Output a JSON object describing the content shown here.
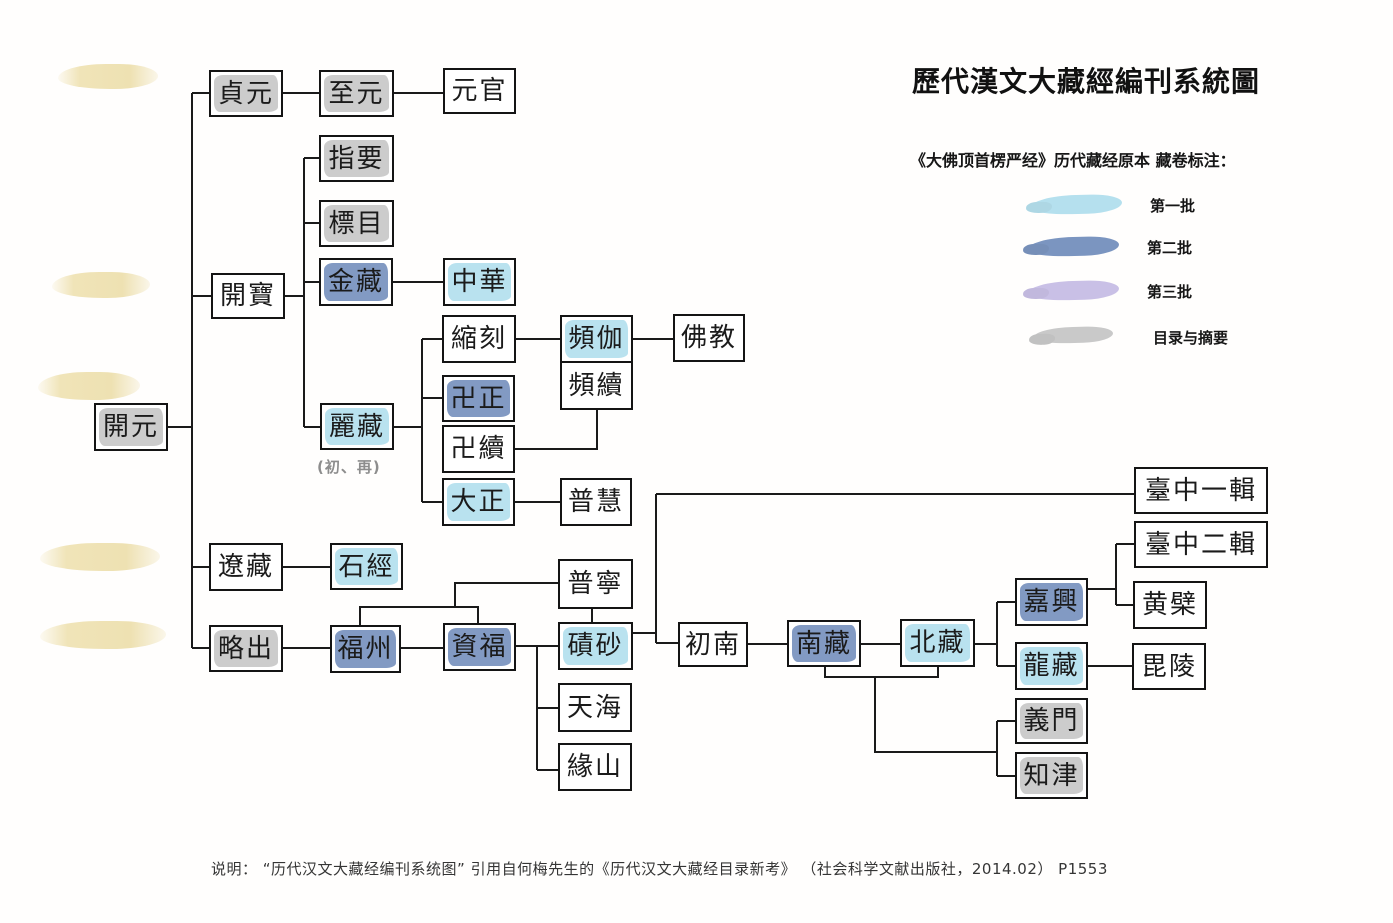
{
  "title": "歷代漢文大藏經編刊系統圖",
  "legend": {
    "heading": "《大佛顶首楞严经》历代藏经原本 藏卷标注：",
    "items": [
      {
        "key": "first",
        "label": "第一批",
        "color": "#b5e0ee"
      },
      {
        "key": "second",
        "label": "第二批",
        "color": "#7b95c0"
      },
      {
        "key": "third",
        "label": "第三批",
        "color": "#c9c0e6"
      },
      {
        "key": "catalog",
        "label": "目录与摘要",
        "color": "#c9c9c9"
      }
    ]
  },
  "annotations": {
    "lizang_note": "(初、再)"
  },
  "caption": "说明： “历代汉文大藏经编刊系统图” 引用自何梅先生的《历代汉文大藏经目录新考》 （社会科学文献出版社，2014.02） P1553",
  "diagram": {
    "highlight_colors": {
      "first": "#b5e0ee",
      "second": "#7b95c0",
      "third": "#c9c0e6",
      "catalog": "#c9c9c9"
    },
    "nodes": [
      {
        "id": "kaiyuan",
        "label": "開元",
        "mark": "catalog",
        "x": 94,
        "y": 403,
        "w": 74,
        "h": 48
      },
      {
        "id": "zhenyuan",
        "label": "貞元",
        "mark": "catalog",
        "x": 209,
        "y": 70,
        "w": 74,
        "h": 47
      },
      {
        "id": "zhiyuan",
        "label": "至元",
        "mark": "catalog",
        "x": 319,
        "y": 70,
        "w": 75,
        "h": 47
      },
      {
        "id": "yuanguan",
        "label": "元官",
        "mark": "none",
        "x": 443,
        "y": 68,
        "w": 73,
        "h": 46
      },
      {
        "id": "zhiyao",
        "label": "指要",
        "mark": "catalog",
        "x": 319,
        "y": 135,
        "w": 75,
        "h": 47
      },
      {
        "id": "biaomu",
        "label": "標目",
        "mark": "catalog",
        "x": 319,
        "y": 200,
        "w": 75,
        "h": 47
      },
      {
        "id": "jinzang",
        "label": "金藏",
        "mark": "second",
        "x": 319,
        "y": 258,
        "w": 74,
        "h": 48
      },
      {
        "id": "zhonghua",
        "label": "中華",
        "mark": "first",
        "x": 443,
        "y": 258,
        "w": 73,
        "h": 48
      },
      {
        "id": "kaibao",
        "label": "開寶",
        "mark": "none",
        "x": 211,
        "y": 273,
        "w": 74,
        "h": 46
      },
      {
        "id": "suoke",
        "label": "縮刻",
        "mark": "none",
        "x": 442,
        "y": 315,
        "w": 74,
        "h": 48
      },
      {
        "id": "pinqie",
        "label": "頻伽",
        "mark": "first",
        "x": 560,
        "y": 315,
        "w": 73,
        "h": 48
      },
      {
        "id": "fojiao",
        "label": "佛教",
        "mark": "none",
        "x": 673,
        "y": 314,
        "w": 72,
        "h": 48
      },
      {
        "id": "pinxu",
        "label": "頻續",
        "mark": "none",
        "x": 560,
        "y": 361,
        "w": 73,
        "h": 49
      },
      {
        "id": "wanzheng",
        "label": "卍正",
        "mark": "second",
        "x": 442,
        "y": 375,
        "w": 73,
        "h": 47
      },
      {
        "id": "lizang",
        "label": "麗藏",
        "mark": "first",
        "x": 320,
        "y": 403,
        "w": 74,
        "h": 47
      },
      {
        "id": "wanxu",
        "label": "卍續",
        "mark": "none",
        "x": 442,
        "y": 425,
        "w": 73,
        "h": 48
      },
      {
        "id": "dazheng",
        "label": "大正",
        "mark": "first",
        "x": 442,
        "y": 478,
        "w": 73,
        "h": 48
      },
      {
        "id": "puhui",
        "label": "普慧",
        "mark": "none",
        "x": 560,
        "y": 478,
        "w": 72,
        "h": 48
      },
      {
        "id": "liaozang",
        "label": "遼藏",
        "mark": "none",
        "x": 209,
        "y": 543,
        "w": 74,
        "h": 48
      },
      {
        "id": "shijing",
        "label": "石經",
        "mark": "first",
        "x": 330,
        "y": 543,
        "w": 73,
        "h": 47
      },
      {
        "id": "lvechu",
        "label": "略出",
        "mark": "catalog",
        "x": 209,
        "y": 625,
        "w": 74,
        "h": 47
      },
      {
        "id": "fuzhou",
        "label": "福州",
        "mark": "second",
        "x": 330,
        "y": 625,
        "w": 71,
        "h": 48
      },
      {
        "id": "zifu",
        "label": "資福",
        "mark": "second",
        "x": 443,
        "y": 623,
        "w": 73,
        "h": 48
      },
      {
        "id": "puning",
        "label": "普寧",
        "mark": "none",
        "x": 558,
        "y": 559,
        "w": 75,
        "h": 50
      },
      {
        "id": "qisha",
        "label": "磧砂",
        "mark": "first",
        "x": 558,
        "y": 622,
        "w": 75,
        "h": 48
      },
      {
        "id": "tianhai",
        "label": "天海",
        "mark": "none",
        "x": 558,
        "y": 683,
        "w": 74,
        "h": 49
      },
      {
        "id": "yuanshan",
        "label": "緣山",
        "mark": "none",
        "x": 558,
        "y": 743,
        "w": 74,
        "h": 48
      },
      {
        "id": "chunan",
        "label": "初南",
        "mark": "none",
        "x": 678,
        "y": 622,
        "w": 70,
        "h": 45
      },
      {
        "id": "nanzang",
        "label": "南藏",
        "mark": "second",
        "x": 787,
        "y": 620,
        "w": 74,
        "h": 47
      },
      {
        "id": "beizang",
        "label": "北藏",
        "mark": "first",
        "x": 900,
        "y": 619,
        "w": 75,
        "h": 48
      },
      {
        "id": "jiaxing",
        "label": "嘉興",
        "mark": "second",
        "x": 1015,
        "y": 578,
        "w": 73,
        "h": 48
      },
      {
        "id": "longzang",
        "label": "龍藏",
        "mark": "first",
        "x": 1015,
        "y": 642,
        "w": 73,
        "h": 48
      },
      {
        "id": "yimen",
        "label": "義門",
        "mark": "catalog",
        "x": 1015,
        "y": 698,
        "w": 73,
        "h": 46
      },
      {
        "id": "zhijin",
        "label": "知津",
        "mark": "catalog",
        "x": 1015,
        "y": 752,
        "w": 73,
        "h": 47
      },
      {
        "id": "taizhong1",
        "label": "臺中一輯",
        "mark": "none",
        "x": 1134,
        "y": 467,
        "w": 134,
        "h": 47
      },
      {
        "id": "taizhong2",
        "label": "臺中二輯",
        "mark": "none",
        "x": 1134,
        "y": 521,
        "w": 134,
        "h": 47
      },
      {
        "id": "huangbo",
        "label": "黄檗",
        "mark": "none",
        "x": 1133,
        "y": 581,
        "w": 74,
        "h": 48
      },
      {
        "id": "piling",
        "label": "毘陵",
        "mark": "none",
        "x": 1132,
        "y": 643,
        "w": 74,
        "h": 47
      }
    ],
    "connectors": [
      "168,427 192,427",
      "192,93 192,648",
      "192,93 209,93",
      "192,296 211,296",
      "192,567 209,567",
      "192,648 209,648",
      "283,93 319,93",
      "394,93 443,93",
      "285,296 304,296",
      "304,158 304,427",
      "304,158 319,158",
      "304,223 319,223",
      "304,282 319,282",
      "304,427 320,427",
      "393,282 443,282",
      "394,427 422,427",
      "422,339 422,502",
      "422,339 442,339",
      "422,398 442,398",
      "422,502 442,502",
      "516,339 560,339",
      "633,339 673,339",
      "515,449 597,449 597,410",
      "515,502 560,502",
      "283,567 330,567",
      "283,648 330,648",
      "401,648 443,648",
      "360,625 360,607 478,607 478,623",
      "455,607 455,583 558,583",
      "592,609 592,622",
      "516,646 558,646",
      "537,646 537,770",
      "537,708 558,708",
      "537,770 558,770",
      "633,633 656,633",
      "656,494 656,643",
      "656,494 1134,494",
      "656,643 678,643",
      "748,644 787,644",
      "861,644 900,644",
      "975,644 997,644",
      "997,602 997,666",
      "997,602 1015,602",
      "997,666 1015,666",
      "825,667 825,677 938,677 938,667",
      "875,677 875,752 997,752",
      "997,721 997,776",
      "997,721 1015,721",
      "997,776 1015,776",
      "1088,589 1116,589",
      "1116,544 1116,605",
      "1116,544 1134,544",
      "1116,605 1133,605",
      "1088,666 1132,666"
    ]
  }
}
